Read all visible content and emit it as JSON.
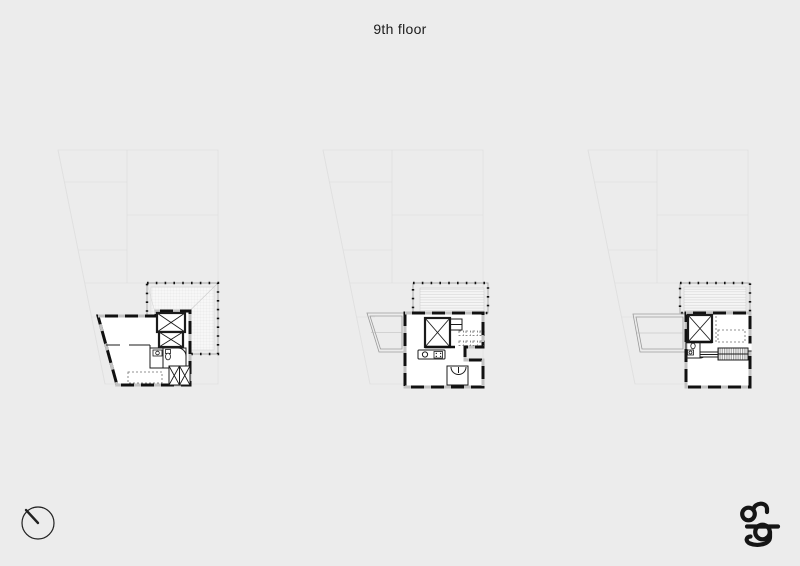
{
  "sheet": {
    "title": "9th floor"
  },
  "colors": {
    "bg": "#ececec",
    "ink": "#1b1b1b",
    "wall": "#111111",
    "faint": "#e0e0e0",
    "terr": "#9a9a9a",
    "gap": "#c2c2c2"
  },
  "icons": {
    "north": "north-arrow-icon",
    "logo": "ag-monogram-logo"
  }
}
